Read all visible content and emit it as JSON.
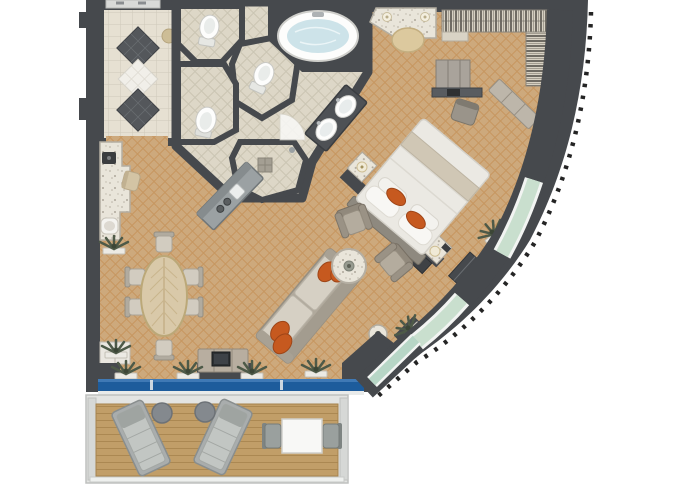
{
  "scene": {
    "title": "Luxury ship suite floor plan, top-down 3D rendered view",
    "canvas_width_px": 680,
    "canvas_height_px": 486
  },
  "palette": {
    "wall": "#46494d",
    "wallDark": "#3a3d41",
    "carpet": "#cda97c",
    "carpetLine": "#c08648",
    "tile": "#ddd7c7",
    "tileLine": "#c6c0ae",
    "hallTile": "#e6e0d2",
    "hallLine": "#cfc9b9",
    "diamondDark": "#54575b",
    "marble": "#e9e5da",
    "wood": "#c19e68",
    "woodLine": "#a5824c",
    "glassBlue": "#1d5c9c",
    "glassGreen": "#c9dfce",
    "glassTeal": "#b7d6c6",
    "orange": "#c6591f",
    "sofaBeige": "#b0a99c",
    "cushion": "#d6d0c4",
    "furnGray": "#9a948a",
    "bedWhite": "#ebe9e3",
    "runner": "#d0c7b5",
    "plant": "#4e5a48",
    "tubWater": "#cde3e9",
    "railing": "#e3e4e2"
  },
  "rooms": [
    {
      "id": "entry-hall",
      "floor": "marble with dark diamond inlay"
    },
    {
      "id": "wc-upper",
      "floor": "tile"
    },
    {
      "id": "wc-lower",
      "floor": "tile"
    },
    {
      "id": "bidet-room",
      "floor": "tile"
    },
    {
      "id": "main-bathroom",
      "floor": "tile"
    },
    {
      "id": "shower-pantry",
      "floor": "tile"
    },
    {
      "id": "dressing-vanity",
      "floor": "carpet"
    },
    {
      "id": "walk-in-closet",
      "floor": "carpet"
    },
    {
      "id": "bedroom",
      "floor": "carpet"
    },
    {
      "id": "living-room",
      "floor": "carpet"
    },
    {
      "id": "dining-area",
      "floor": "carpet"
    },
    {
      "id": "balcony",
      "floor": "teak decking"
    }
  ],
  "furniture_by_room": {
    "entry-hall": [
      "double entry door",
      "diamond inlay floor",
      "wall niche"
    ],
    "bathroom": [
      "oval whirlpool tub",
      "double sink vanity",
      "toilet x2",
      "bidet",
      "walk-in shower with drain"
    ],
    "pantry": [
      "bar counter with sink and burners"
    ],
    "dressing": [
      "vanity table with two sconces",
      "half-round stool"
    ],
    "closet": [
      "hanging rods with clothes",
      "shelf unit",
      "side hanging column"
    ],
    "office": [
      "cabinet",
      "desk with laptop",
      "desk chair",
      "slanted bench"
    ],
    "bedroom": [
      "king bed with orange accent pillows",
      "headboard partition wall",
      "nightstand with lamp x2",
      "minibar cabinet",
      "wall cabinet",
      "planters"
    ],
    "living": [
      "sofa with orange accent pillows",
      "round marble coffee table",
      "armchair x2",
      "round side table",
      "tv console with tv",
      "granite wet-bar counter",
      "bar stool",
      "espresso machine",
      "counter sink",
      "plant cabinet",
      "window planters x4"
    ],
    "dining": [
      "oval wood table with leaf veneer",
      "dining chair x6"
    ],
    "balcony": [
      "sun lounger x2",
      "round side table x2",
      "square dining table",
      "balcony chair x2",
      "railing"
    ]
  }
}
